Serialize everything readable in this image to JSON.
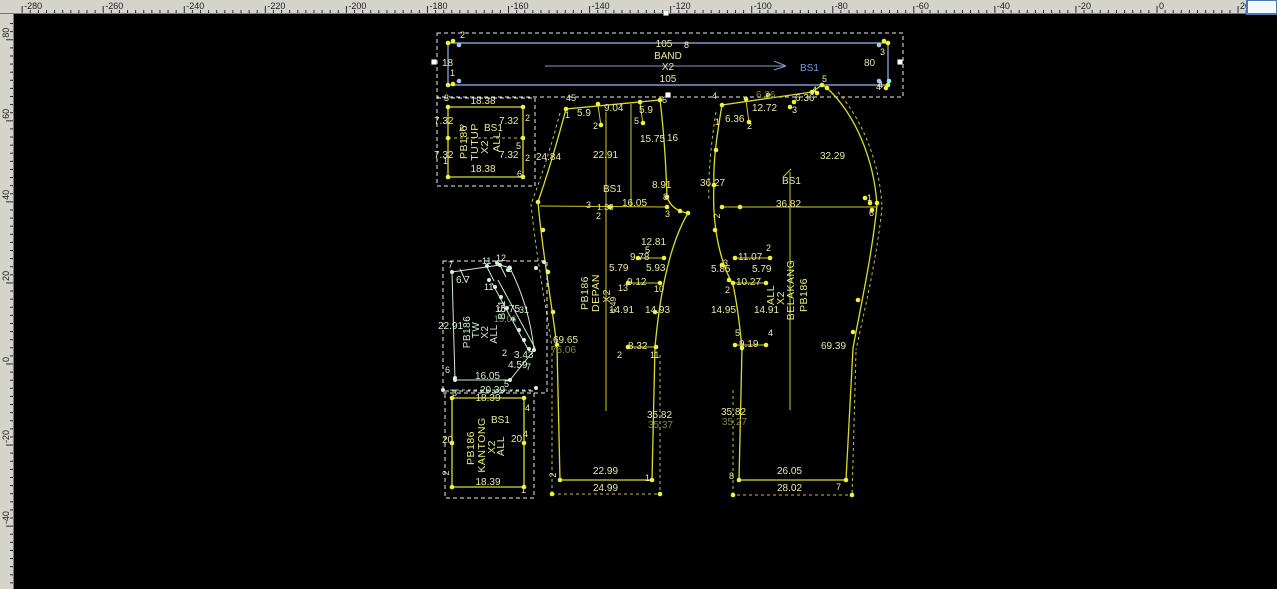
{
  "app": {
    "type": "pattern-cad-canvas",
    "background": "#000000",
    "colors": {
      "pattern_yellow": "#dcdc28",
      "pattern_green": "#cfe9cf",
      "band_blue": "#7e9ccc",
      "selection_white": "#ececec",
      "ruler_gray": "#d6d3cd"
    }
  },
  "rulers": {
    "top_labels": [
      "-280",
      "-260",
      "-240",
      "-220",
      "-200",
      "-180",
      "-160",
      "-140",
      "-120",
      "-100",
      "-80",
      "-60",
      "-40",
      "-20",
      "0",
      "20"
    ],
    "left_labels": [
      "80",
      "60",
      "40",
      "20",
      "0",
      "-20",
      "-40"
    ]
  },
  "pieces": {
    "band": {
      "piece_name": "BAND",
      "labels": [
        {
          "t": "2",
          "x": 460,
          "y": 38,
          "k": "p"
        },
        {
          "t": "105",
          "x": 664,
          "y": 47,
          "k": "m",
          "a": "middle"
        },
        {
          "t": "8",
          "x": 684,
          "y": 48,
          "k": "p"
        },
        {
          "t": "BAND",
          "x": 668,
          "y": 59,
          "k": "m",
          "a": "middle"
        },
        {
          "t": "X2",
          "x": 668,
          "y": 70,
          "k": "m",
          "a": "middle"
        },
        {
          "t": "105",
          "x": 668,
          "y": 82,
          "k": "m",
          "a": "middle"
        },
        {
          "t": "BS1",
          "x": 800,
          "y": 71,
          "k": "b"
        },
        {
          "t": "18",
          "x": 442,
          "y": 66,
          "k": "m"
        },
        {
          "t": "1",
          "x": 450,
          "y": 76,
          "k": "p"
        },
        {
          "t": "3",
          "x": 880,
          "y": 55,
          "k": "p"
        },
        {
          "t": "80",
          "x": 864,
          "y": 66,
          "k": "m"
        },
        {
          "t": "4",
          "x": 876,
          "y": 90,
          "k": "p"
        }
      ]
    },
    "tutup": {
      "piece_name": "TUTUP",
      "labels": [
        {
          "t": "3",
          "x": 444,
          "y": 101,
          "k": "p"
        },
        {
          "t": "18.38",
          "x": 483,
          "y": 104,
          "k": "m",
          "a": "middle"
        },
        {
          "t": "7.32",
          "x": 434,
          "y": 124,
          "k": "m"
        },
        {
          "t": "7.32",
          "x": 499,
          "y": 124,
          "k": "m"
        },
        {
          "t": "2",
          "x": 525,
          "y": 121,
          "k": "p"
        },
        {
          "t": "2",
          "x": 459,
          "y": 131,
          "k": "p"
        },
        {
          "t": "5",
          "x": 516,
          "y": 149,
          "k": "p"
        },
        {
          "t": "7.32",
          "x": 434,
          "y": 158,
          "k": "m"
        },
        {
          "t": "7.32",
          "x": 499,
          "y": 158,
          "k": "m"
        },
        {
          "t": "2",
          "x": 525,
          "y": 161,
          "k": "p"
        },
        {
          "t": "1",
          "x": 443,
          "y": 164,
          "k": "p"
        },
        {
          "t": "6",
          "x": 517,
          "y": 177,
          "k": "p"
        },
        {
          "t": "18.38",
          "x": 483,
          "y": 172,
          "k": "m",
          "a": "middle"
        },
        {
          "t": "PB186",
          "x": 467,
          "y": 142,
          "k": "n",
          "r": 1
        },
        {
          "t": "TUTUP",
          "x": 478,
          "y": 142,
          "k": "n",
          "r": 1
        },
        {
          "t": "X2",
          "x": 488,
          "y": 147,
          "k": "n",
          "r": 1
        },
        {
          "t": "BS1",
          "x": 484,
          "y": 131,
          "k": "m"
        },
        {
          "t": "ALL",
          "x": 500,
          "y": 142,
          "k": "n",
          "r": 1
        }
      ]
    },
    "depan": {
      "piece_name": "DEPAN",
      "labels": [
        {
          "t": "45",
          "x": 566,
          "y": 101,
          "k": "p"
        },
        {
          "t": "1",
          "x": 565,
          "y": 118,
          "k": "p"
        },
        {
          "t": "5.9",
          "x": 577,
          "y": 116,
          "k": "m"
        },
        {
          "t": "2",
          "x": 593,
          "y": 129,
          "k": "p"
        },
        {
          "t": "9.04",
          "x": 604,
          "y": 111,
          "k": "m"
        },
        {
          "t": "5.9",
          "x": 639,
          "y": 113,
          "k": "m"
        },
        {
          "t": "5",
          "x": 634,
          "y": 124,
          "k": "p"
        },
        {
          "t": "6",
          "x": 662,
          "y": 103,
          "k": "p"
        },
        {
          "t": "15.75",
          "x": 640,
          "y": 142,
          "k": "m"
        },
        {
          "t": "16",
          "x": 667,
          "y": 141,
          "k": "m"
        },
        {
          "t": "24.84",
          "x": 536,
          "y": 160,
          "k": "m"
        },
        {
          "t": "22.91",
          "x": 593,
          "y": 158,
          "k": "m"
        },
        {
          "t": "BS1",
          "x": 603,
          "y": 192,
          "k": "m"
        },
        {
          "t": "8.91",
          "x": 652,
          "y": 188,
          "k": "m"
        },
        {
          "t": "3",
          "x": 586,
          "y": 208,
          "k": "p"
        },
        {
          "t": "1.33",
          "x": 597,
          "y": 210,
          "k": "m2"
        },
        {
          "t": "16.05",
          "x": 622,
          "y": 206,
          "k": "m"
        },
        {
          "t": "8",
          "x": 663,
          "y": 200,
          "k": "p"
        },
        {
          "t": "3",
          "x": 665,
          "y": 217,
          "k": "p"
        },
        {
          "t": "2",
          "x": 596,
          "y": 219,
          "k": "p"
        },
        {
          "t": "12.81",
          "x": 641,
          "y": 245,
          "k": "m"
        },
        {
          "t": "5",
          "x": 645,
          "y": 253,
          "k": "p"
        },
        {
          "t": "9.78",
          "x": 630,
          "y": 260,
          "k": "m"
        },
        {
          "t": "5.79",
          "x": 609,
          "y": 271,
          "k": "m"
        },
        {
          "t": "5.93",
          "x": 646,
          "y": 271,
          "k": "m"
        },
        {
          "t": "9.12",
          "x": 627,
          "y": 285,
          "k": "m"
        },
        {
          "t": "13",
          "x": 618,
          "y": 291,
          "k": "p"
        },
        {
          "t": "10",
          "x": 654,
          "y": 292,
          "k": "p"
        },
        {
          "t": "4.49",
          "x": 616,
          "y": 305,
          "k": "m2",
          "r": 1
        },
        {
          "t": "14.91",
          "x": 609,
          "y": 313,
          "k": "m"
        },
        {
          "t": "14.93",
          "x": 645,
          "y": 313,
          "k": "m"
        },
        {
          "t": "8.32",
          "x": 628,
          "y": 349,
          "k": "m"
        },
        {
          "t": "2",
          "x": 617,
          "y": 358,
          "k": "p"
        },
        {
          "t": "11",
          "x": 650,
          "y": 358,
          "k": "p"
        },
        {
          "t": "69.65",
          "x": 553,
          "y": 343,
          "k": "m"
        },
        {
          "t": "75.06",
          "x": 551,
          "y": 353,
          "k": "d"
        },
        {
          "t": "35.82",
          "x": 647,
          "y": 418,
          "k": "m"
        },
        {
          "t": "35.37",
          "x": 648,
          "y": 428,
          "k": "d"
        },
        {
          "t": "22.99",
          "x": 593,
          "y": 474,
          "k": "m"
        },
        {
          "t": "1",
          "x": 645,
          "y": 481,
          "k": "p"
        },
        {
          "t": "24.99",
          "x": 593,
          "y": 491,
          "k": "m"
        },
        {
          "t": "2",
          "x": 556,
          "y": 475,
          "k": "p",
          "r": 1
        },
        {
          "t": "PB186",
          "x": 588,
          "y": 293,
          "k": "n",
          "r": 1
        },
        {
          "t": "DEPAN",
          "x": 599,
          "y": 293,
          "k": "n",
          "r": 1
        },
        {
          "t": "X2",
          "x": 610,
          "y": 296,
          "k": "n",
          "r": 1
        }
      ]
    },
    "belakang": {
      "piece_name": "BELAKANG",
      "labels": [
        {
          "t": "4",
          "x": 712,
          "y": 99,
          "k": "p"
        },
        {
          "t": "1",
          "x": 715,
          "y": 125,
          "k": "p"
        },
        {
          "t": "6.36",
          "x": 725,
          "y": 122,
          "k": "m"
        },
        {
          "t": "2",
          "x": 747,
          "y": 129,
          "k": "p"
        },
        {
          "t": "12.72",
          "x": 752,
          "y": 111,
          "k": "m"
        },
        {
          "t": "3",
          "x": 792,
          "y": 113,
          "k": "p"
        },
        {
          "t": "6.36",
          "x": 756,
          "y": 98,
          "k": "d"
        },
        {
          "t": "6.36",
          "x": 795,
          "y": 101,
          "k": "m"
        },
        {
          "t": "4",
          "x": 812,
          "y": 93,
          "k": "p"
        },
        {
          "t": "5",
          "x": 822,
          "y": 82,
          "k": "p"
        },
        {
          "t": "4",
          "x": 878,
          "y": 88,
          "k": "p"
        },
        {
          "t": "36.27",
          "x": 700,
          "y": 186,
          "k": "m"
        },
        {
          "t": "32.29",
          "x": 820,
          "y": 159,
          "k": "m"
        },
        {
          "t": "BS1",
          "x": 782,
          "y": 184,
          "k": "m"
        },
        {
          "t": "36.82",
          "x": 776,
          "y": 207,
          "k": "m"
        },
        {
          "t": "2",
          "x": 720,
          "y": 216,
          "k": "p",
          "r": 1
        },
        {
          "t": "1",
          "x": 867,
          "y": 201,
          "k": "p"
        },
        {
          "t": "6",
          "x": 869,
          "y": 216,
          "k": "p"
        },
        {
          "t": "11.07",
          "x": 738,
          "y": 260,
          "k": "m"
        },
        {
          "t": "2",
          "x": 766,
          "y": 251,
          "k": "p"
        },
        {
          "t": "3",
          "x": 723,
          "y": 266,
          "k": "p"
        },
        {
          "t": "5.85",
          "x": 711,
          "y": 272,
          "k": "m"
        },
        {
          "t": "5.79",
          "x": 752,
          "y": 272,
          "k": "m"
        },
        {
          "t": "10.27",
          "x": 736,
          "y": 285,
          "k": "m"
        },
        {
          "t": "2",
          "x": 725,
          "y": 293,
          "k": "p"
        },
        {
          "t": "14.95",
          "x": 711,
          "y": 313,
          "k": "m"
        },
        {
          "t": "14.91",
          "x": 754,
          "y": 313,
          "k": "m"
        },
        {
          "t": "5",
          "x": 735,
          "y": 336,
          "k": "p"
        },
        {
          "t": "4",
          "x": 768,
          "y": 336,
          "k": "p"
        },
        {
          "t": "9.19",
          "x": 739,
          "y": 347,
          "k": "m"
        },
        {
          "t": "69.39",
          "x": 821,
          "y": 349,
          "k": "m"
        },
        {
          "t": "35.82",
          "x": 721,
          "y": 415,
          "k": "m"
        },
        {
          "t": "35.27",
          "x": 722,
          "y": 425,
          "k": "d"
        },
        {
          "t": "26.05",
          "x": 777,
          "y": 474,
          "k": "m"
        },
        {
          "t": "8",
          "x": 729,
          "y": 479,
          "k": "p"
        },
        {
          "t": "28.02",
          "x": 777,
          "y": 491,
          "k": "m"
        },
        {
          "t": "7",
          "x": 836,
          "y": 490,
          "k": "p"
        },
        {
          "t": "PB186",
          "x": 807,
          "y": 295,
          "k": "n",
          "r": 1
        },
        {
          "t": "BELAKANG",
          "x": 794,
          "y": 290,
          "k": "n",
          "r": 1
        },
        {
          "t": "X2",
          "x": 784,
          "y": 298,
          "k": "n",
          "r": 1
        },
        {
          "t": "ALL",
          "x": 774,
          "y": 295,
          "k": "n",
          "r": 1
        }
      ]
    },
    "saku": {
      "piece_name": "TW",
      "labels": [
        {
          "t": "7",
          "x": 448,
          "y": 268,
          "k": "q"
        },
        {
          "t": "6.7",
          "x": 456,
          "y": 283,
          "k": "g"
        },
        {
          "t": "11",
          "x": 482,
          "y": 264,
          "k": "q"
        },
        {
          "t": "12",
          "x": 496,
          "y": 261,
          "k": "q"
        },
        {
          "t": "2",
          "x": 507,
          "y": 272,
          "k": "q"
        },
        {
          "t": "11",
          "x": 484,
          "y": 290,
          "k": "q"
        },
        {
          "t": "15.75",
          "x": 495,
          "y": 312,
          "k": "g"
        },
        {
          "t": "31",
          "x": 519,
          "y": 313,
          "k": "q"
        },
        {
          "t": "15.06",
          "x": 494,
          "y": 322,
          "k": "e"
        },
        {
          "t": "22.91",
          "x": 438,
          "y": 329,
          "k": "g"
        },
        {
          "t": "BS1",
          "x": 505,
          "y": 310,
          "k": "g",
          "r": 1
        },
        {
          "t": "PB186",
          "x": 470,
          "y": 332,
          "k": "gn",
          "r": 1
        },
        {
          "t": "TW",
          "x": 479,
          "y": 330,
          "k": "gn",
          "r": 1
        },
        {
          "t": "X2",
          "x": 488,
          "y": 332,
          "k": "gn",
          "r": 1
        },
        {
          "t": "ALL",
          "x": 497,
          "y": 334,
          "k": "gn",
          "r": 1
        },
        {
          "t": "2",
          "x": 502,
          "y": 356,
          "k": "q"
        },
        {
          "t": "3.43",
          "x": 514,
          "y": 358,
          "k": "g"
        },
        {
          "t": "4.59",
          "x": 508,
          "y": 368,
          "k": "g"
        },
        {
          "t": "7",
          "x": 526,
          "y": 370,
          "k": "q"
        },
        {
          "t": "6",
          "x": 445,
          "y": 373,
          "k": "q"
        },
        {
          "t": "16.05",
          "x": 475,
          "y": 379,
          "k": "g"
        },
        {
          "t": "5",
          "x": 504,
          "y": 387,
          "k": "q"
        },
        {
          "t": "20.39",
          "x": 480,
          "y": 393,
          "k": "g"
        }
      ]
    },
    "kantong": {
      "piece_name": "KANTONG",
      "labels": [
        {
          "t": "3",
          "x": 452,
          "y": 396,
          "k": "p"
        },
        {
          "t": "18.39",
          "x": 488,
          "y": 401,
          "k": "m",
          "a": "middle"
        },
        {
          "t": "4",
          "x": 525,
          "y": 411,
          "k": "p"
        },
        {
          "t": "20",
          "x": 442,
          "y": 443,
          "k": "m"
        },
        {
          "t": "20",
          "x": 511,
          "y": 442,
          "k": "m"
        },
        {
          "t": "4",
          "x": 523,
          "y": 437,
          "k": "p"
        },
        {
          "t": "2",
          "x": 449,
          "y": 473,
          "k": "p",
          "r": 1
        },
        {
          "t": "18.39",
          "x": 488,
          "y": 485,
          "k": "m",
          "a": "middle"
        },
        {
          "t": "1",
          "x": 521,
          "y": 493,
          "k": "p"
        },
        {
          "t": "PB186",
          "x": 474,
          "y": 448,
          "k": "n",
          "r": 1
        },
        {
          "t": "KANTONG",
          "x": 485,
          "y": 445,
          "k": "n",
          "r": 1
        },
        {
          "t": "X2",
          "x": 495,
          "y": 447,
          "k": "n",
          "r": 1
        },
        {
          "t": "ALL",
          "x": 504,
          "y": 446,
          "k": "n",
          "r": 1
        },
        {
          "t": "BS1",
          "x": 491,
          "y": 423,
          "k": "m"
        }
      ]
    }
  }
}
